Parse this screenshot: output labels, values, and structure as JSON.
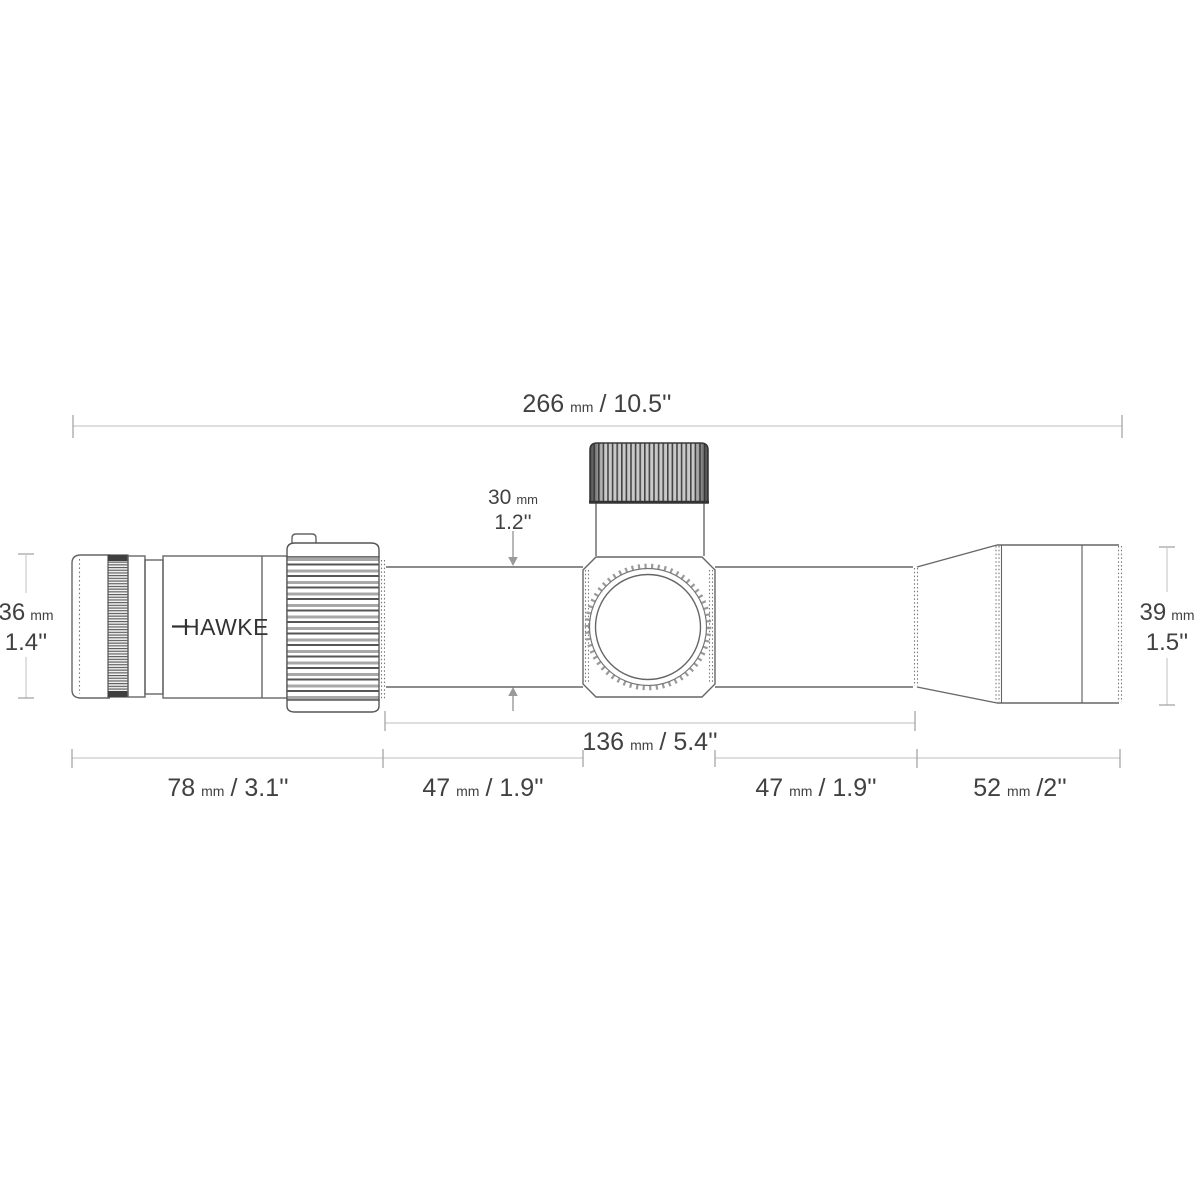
{
  "diagram_title": "Riflescope dimension diagram (side view)",
  "brand": {
    "logo_text": "HAWKE"
  },
  "dimensions": {
    "overall_length": {
      "value": "266",
      "unit": "mm",
      "imperial": "/ 10.5''"
    },
    "tube_section_length": {
      "value": "136",
      "unit": "mm",
      "imperial": "/ 5.4''"
    },
    "eyepiece_length": {
      "value": "78",
      "unit": "mm",
      "imperial": "/ 3.1''"
    },
    "rear_tube_length": {
      "value": "47",
      "unit": "mm",
      "imperial": "/ 1.9''"
    },
    "front_tube_length": {
      "value": "47",
      "unit": "mm",
      "imperial": "/ 1.9''"
    },
    "objective_length": {
      "value": "52",
      "unit": "mm",
      "imperial": "/2''"
    },
    "eyepiece_diameter": {
      "value": "36",
      "unit": "mm",
      "imperial": "1.4''"
    },
    "tube_diameter": {
      "value": "30",
      "unit": "mm",
      "imperial": "1.2''"
    },
    "objective_diameter": {
      "value": "39",
      "unit": "mm",
      "imperial": "1.5''"
    }
  },
  "colors": {
    "background": "#ffffff",
    "outline": "#666666",
    "dark_detail": "#3a3a3a",
    "dimension_line": "#cbcbcb",
    "dimension_tick": "#9e9e9e",
    "arrow": "#9a9a9a",
    "text": "#414141"
  }
}
